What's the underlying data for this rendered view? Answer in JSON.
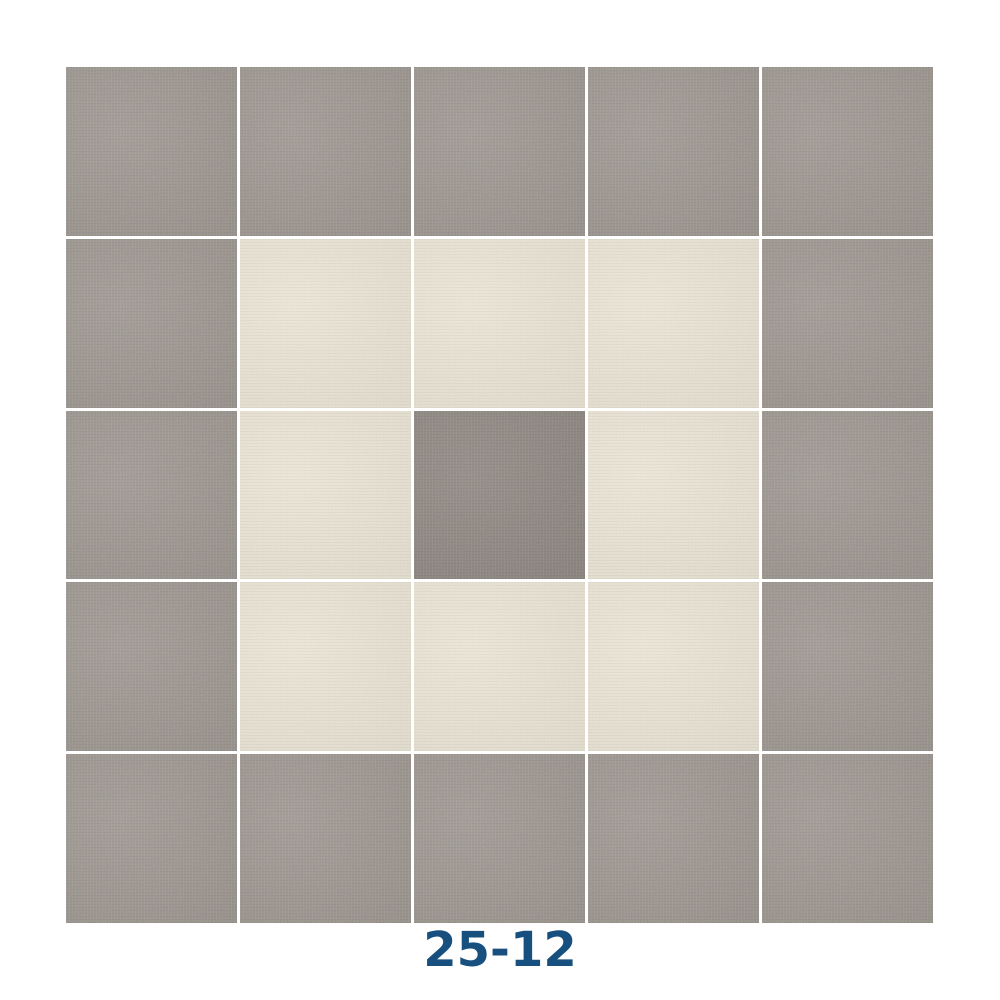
{
  "label": {
    "text": "25-12",
    "color": "#17507f"
  },
  "grid": {
    "rows": 5,
    "cols": 5,
    "gap_color": "#ffffff",
    "pattern": [
      "gray",
      "gray",
      "gray",
      "gray",
      "gray",
      "gray",
      "cream",
      "cream",
      "cream",
      "gray",
      "gray",
      "cream",
      "dark",
      "cream",
      "gray",
      "gray",
      "cream",
      "cream",
      "cream",
      "gray",
      "gray",
      "gray",
      "gray",
      "gray",
      "gray"
    ]
  },
  "colors": {
    "gray": "#9a938d",
    "cream": "#e8e2d2",
    "dark": "#8b847e"
  },
  "tile_names": {
    "gray": "gray-carpet-tile",
    "cream": "cream-carpet-tile",
    "dark": "dark-gray-center-carpet-tile"
  }
}
